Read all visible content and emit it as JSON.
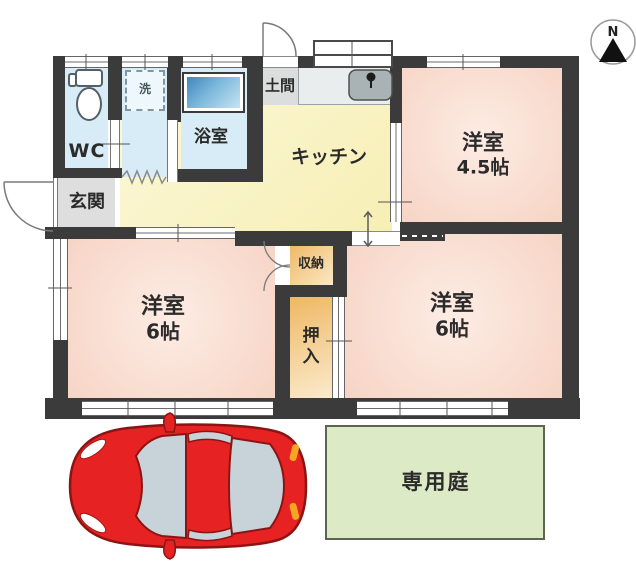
{
  "compass": {
    "label": "N"
  },
  "rooms": {
    "wc": {
      "label": "WC"
    },
    "laundry": {
      "label": "洗"
    },
    "bath": {
      "label": "浴室"
    },
    "doma": {
      "label": "土間"
    },
    "kitchen": {
      "label": "キッチン"
    },
    "entrance": {
      "label": "玄関"
    },
    "storage": {
      "label": "収納"
    },
    "closet": {
      "label": "押入"
    },
    "garden": {
      "label": "専用庭"
    },
    "west45": {
      "name": "洋室",
      "size": "4.5帖"
    },
    "west6a": {
      "name": "洋室",
      "size": "6帖"
    },
    "west6b": {
      "name": "洋室",
      "size": "6帖"
    }
  },
  "colors": {
    "wall": "#3b3b3b",
    "room_pink": "#f8dcd0",
    "kitchen_yellow": "#f8f2c2",
    "wet_blue": "#d7ecf6",
    "closet_orange": "#f2c27c",
    "garden_green": "#dcebc5",
    "entrance_gray": "#dedede",
    "car_red": "#e62222",
    "bathtub_blue": "#3f87ba"
  }
}
